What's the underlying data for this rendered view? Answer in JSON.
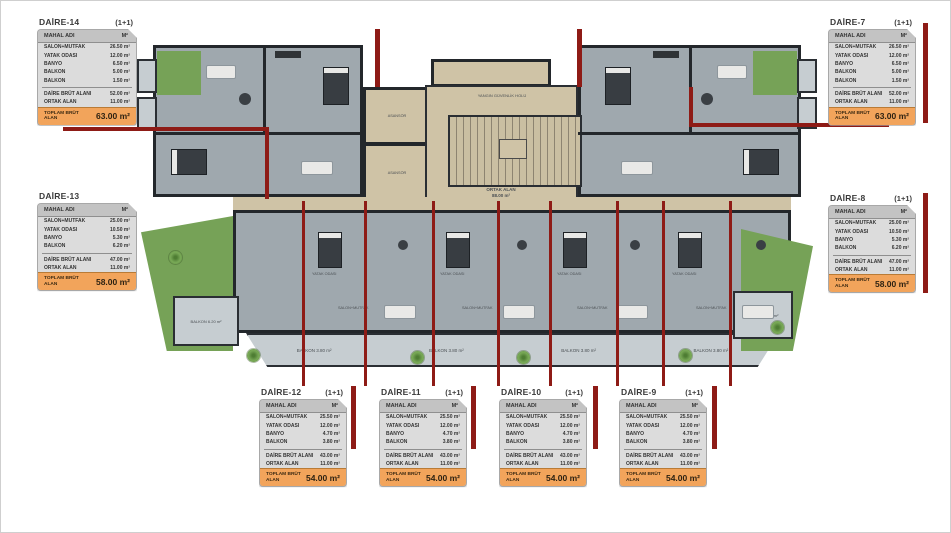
{
  "page": {
    "bg": "#ffffff",
    "frame": "#cfcfcf"
  },
  "header": {
    "col_name": "MAHAL ADI",
    "col_unit": "M²"
  },
  "colors": {
    "accent_orange": "#f2a45b",
    "red_line": "#8e1b16",
    "room_fill": "#9fa8ae",
    "common_fill": "#cfc3a6",
    "green_fill": "#76a257",
    "wall": "#23272b",
    "balcony_fill": "#c6cdd1"
  },
  "cards": [
    {
      "title": "DAİRE-14",
      "plan_type": "(1+1)",
      "rooms": [
        [
          "SALON+MUTFAK",
          "26.50 m²"
        ],
        [
          "YATAK ODASI",
          "12.00 m²"
        ],
        [
          "BANYO",
          "6.50 m²"
        ],
        [
          "BALKON",
          "5.00 m²"
        ],
        [
          "BALKON",
          "1.50 m²"
        ]
      ],
      "brut_label": "DAİRE BRÜT ALANI",
      "brut": "52.00 m²",
      "ortak_label": "ORTAK ALAN",
      "ortak": "11.00 m²",
      "total_label": "TOPLAM BRÜT ALAN",
      "total": "63.00 m²"
    },
    {
      "title": "DAİRE-13",
      "plan_type": "",
      "rooms": [
        [
          "SALON+MUTFAK",
          "25.00 m²"
        ],
        [
          "YATAK ODASI",
          "10.50 m²"
        ],
        [
          "BANYO",
          "5.30 m²"
        ],
        [
          "BALKON",
          "6.20 m²"
        ]
      ],
      "brut_label": "DAİRE BRÜT ALANI",
      "brut": "47.00 m²",
      "ortak_label": "ORTAK ALAN",
      "ortak": "11.00 m²",
      "total_label": "TOPLAM BRÜT ALAN",
      "total": "58.00 m²"
    },
    {
      "title": "DAİRE-7",
      "plan_type": "(1+1)",
      "rooms": [
        [
          "SALON+MUTFAK",
          "26.50 m²"
        ],
        [
          "YATAK ODASI",
          "12.00 m²"
        ],
        [
          "BANYO",
          "6.50 m²"
        ],
        [
          "BALKON",
          "5.00 m²"
        ],
        [
          "BALKON",
          "1.50 m²"
        ]
      ],
      "brut_label": "DAİRE BRÜT ALANI",
      "brut": "52.00 m²",
      "ortak_label": "ORTAK ALAN",
      "ortak": "11.00 m²",
      "total_label": "TOPLAM BRÜT ALAN",
      "total": "63.00 m²"
    },
    {
      "title": "DAİRE-8",
      "plan_type": "(1+1)",
      "rooms": [
        [
          "SALON+MUTFAK",
          "25.00 m²"
        ],
        [
          "YATAK ODASI",
          "10.50 m²"
        ],
        [
          "BANYO",
          "5.30 m²"
        ],
        [
          "BALKON",
          "6.20 m²"
        ]
      ],
      "brut_label": "DAİRE BRÜT ALANI",
      "brut": "47.00 m²",
      "ortak_label": "ORTAK ALAN",
      "ortak": "11.00 m²",
      "total_label": "TOPLAM BRÜT ALAN",
      "total": "58.00 m²"
    },
    {
      "title": "DAİRE-12",
      "plan_type": "(1+1)",
      "rooms": [
        [
          "SALON+MUTFAK",
          "25.50 m²"
        ],
        [
          "YATAK ODASI",
          "12.00 m²"
        ],
        [
          "BANYO",
          "4.70 m²"
        ],
        [
          "BALKON",
          "3.80 m²"
        ]
      ],
      "brut_label": "DAİRE BRÜT ALANI",
      "brut": "43.00 m²",
      "ortak_label": "ORTAK ALAN",
      "ortak": "11.00 m²",
      "total_label": "TOPLAM BRÜT ALAN",
      "total": "54.00 m²"
    },
    {
      "title": "DAİRE-11",
      "plan_type": "(1+1)",
      "rooms": [
        [
          "SALON+MUTFAK",
          "25.50 m²"
        ],
        [
          "YATAK ODASI",
          "12.00 m²"
        ],
        [
          "BANYO",
          "4.70 m²"
        ],
        [
          "BALKON",
          "3.80 m²"
        ]
      ],
      "brut_label": "DAİRE BRÜT ALANI",
      "brut": "43.00 m²",
      "ortak_label": "ORTAK ALAN",
      "ortak": "11.00 m²",
      "total_label": "TOPLAM BRÜT ALAN",
      "total": "54.00 m²"
    },
    {
      "title": "DAİRE-10",
      "plan_type": "(1+1)",
      "rooms": [
        [
          "SALON+MUTFAK",
          "25.50 m²"
        ],
        [
          "YATAK ODASI",
          "12.00 m²"
        ],
        [
          "BANYO",
          "4.70 m²"
        ],
        [
          "BALKON",
          "3.80 m²"
        ]
      ],
      "brut_label": "DAİRE BRÜT ALANI",
      "brut": "43.00 m²",
      "ortak_label": "ORTAK ALAN",
      "ortak": "11.00 m²",
      "total_label": "TOPLAM BRÜT ALAN",
      "total": "54.00 m²"
    },
    {
      "title": "DAİRE-9",
      "plan_type": "(1+1)",
      "rooms": [
        [
          "SALON+MUTFAK",
          "25.50 m²"
        ],
        [
          "YATAK ODASI",
          "12.00 m²"
        ],
        [
          "BANYO",
          "4.70 m²"
        ],
        [
          "BALKON",
          "3.80 m²"
        ]
      ],
      "brut_label": "DAİRE BRÜT ALANI",
      "brut": "43.00 m²",
      "ortak_label": "ORTAK ALAN",
      "ortak": "11.00 m²",
      "total_label": "TOPLAM BRÜT ALAN",
      "total": "54.00 m²"
    }
  ],
  "plan": {
    "labels": {
      "fire_hall": "YANGIN GÜVENLİK HOLÜ",
      "elevator": "ASANSÖR",
      "common_area": "ORTAK ALAN",
      "common_area_value": "88.00 m²",
      "salon": "SALON+MUTFAK",
      "yatak": "YATAK ODASI",
      "balkon": "BALKON"
    },
    "balcony_labels": [
      "BALKON 3.80 m²",
      "BALKON 3.80 m²",
      "BALKON 3.80 m²",
      "BALKON 3.80 m²"
    ],
    "side_balcony_labels": [
      "BALKON 6.20 m²",
      "BALKON 6.20 m²"
    ]
  }
}
